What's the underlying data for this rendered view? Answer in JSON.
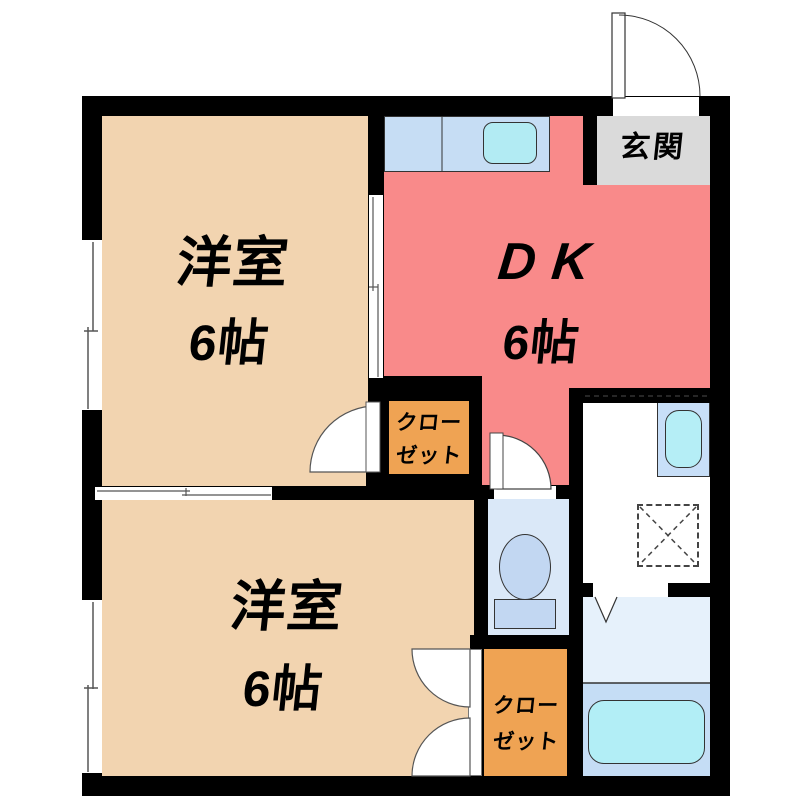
{
  "plan": {
    "rooms": {
      "western_top": {
        "name": "洋室",
        "size": "6帖"
      },
      "western_bottom": {
        "name": "洋室",
        "size": "6帖"
      },
      "dk": {
        "name": "DK",
        "size": "6帖"
      },
      "entrance": {
        "name": "玄関"
      },
      "closet_top": {
        "line1": "クロー",
        "line2": "ゼット"
      },
      "closet_bottom": {
        "line1": "クロー",
        "line2": "ゼット"
      }
    },
    "fixtures": [
      "kitchen-sink",
      "toilet",
      "washbasin",
      "bathtub",
      "washing-machine-space"
    ],
    "doors": [
      "entrance-swing-door",
      "room-swing-door",
      "toilet-swing-door",
      "closet-double-doors",
      "bathroom-folding-door",
      "sliding-door-room-dk",
      "sliding-door-room-room"
    ],
    "windows": [
      "left-wall-window-upper",
      "left-wall-window-lower"
    ],
    "colors": {
      "wall": "#000000",
      "western_room": "#F2D4B0",
      "dk": "#F98A8A",
      "closet": "#EFA353",
      "entrance_floor": "#DADADA",
      "kitchen_counter": "#C6DDF4",
      "sink": "#B2EBF3",
      "toilet_room": "#DAE8F8",
      "toilet_fixture": "#C2D7F2",
      "washbasin_unit": "#C8DFF8",
      "bathroom_upper": "#E6F1FB",
      "bathroom_lower": "#C5DDF5",
      "bathtub": "#B2EEF6"
    }
  }
}
